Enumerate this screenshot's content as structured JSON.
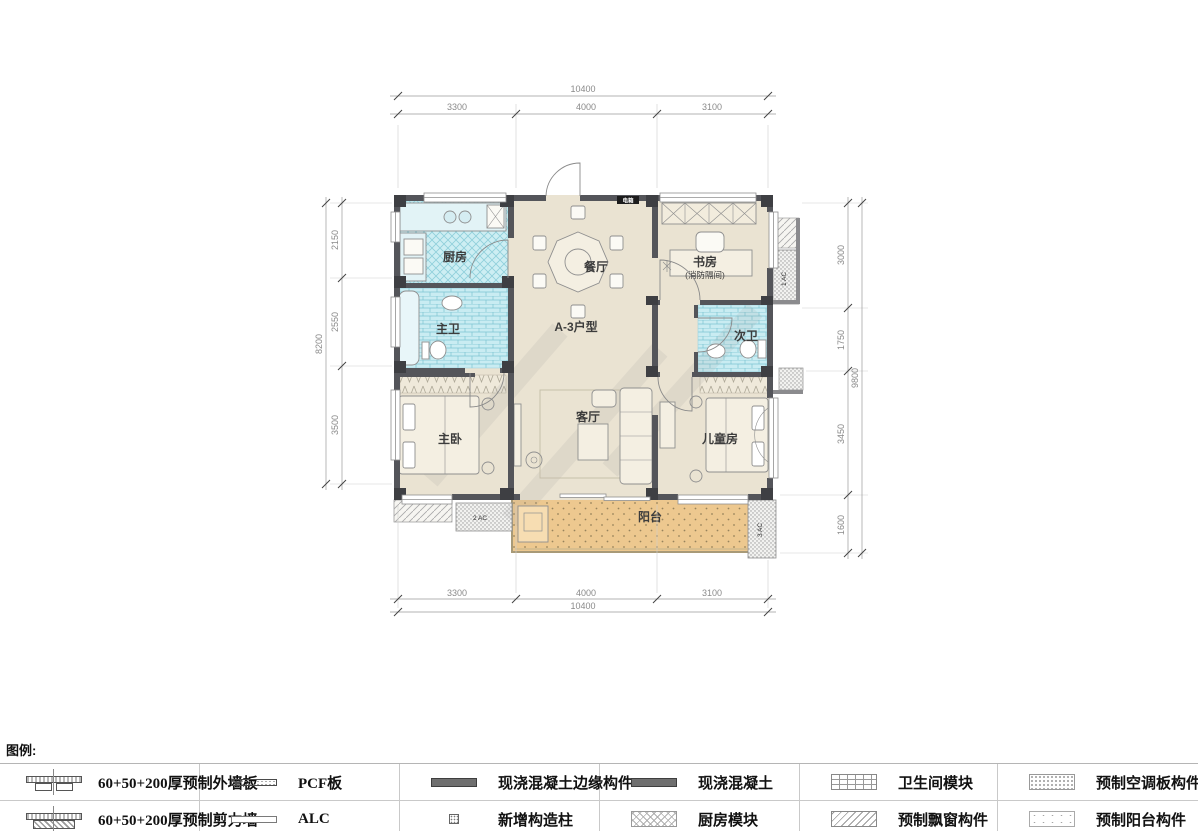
{
  "plan": {
    "unit_label": "A-3户型",
    "rooms": {
      "kitchen": "厨房",
      "dining": "餐厅",
      "study": "书房",
      "study_sub": "(消防隔间)",
      "master_bath": "主卫",
      "second_bath": "次卫",
      "master_bedroom": "主卧",
      "living": "客厅",
      "kids": "儿童房",
      "balcony": "阳台"
    },
    "small_labels": {
      "electrical_box": "电箱",
      "ac1": "1 AC",
      "ac2": "2 AC",
      "ac3": "3 AC"
    }
  },
  "dims": {
    "top": {
      "total": "10400",
      "segments": [
        "3300",
        "4000",
        "3100"
      ]
    },
    "bottom": {
      "total": "10400",
      "segments": [
        "3300",
        "4000",
        "3100"
      ]
    },
    "left": {
      "total": "8200",
      "segments": [
        "2150",
        "2550",
        "3500"
      ]
    },
    "right": {
      "total": "9800",
      "segments": [
        "3000",
        "1750",
        "3450",
        "1600"
      ]
    }
  },
  "legend": {
    "title": "图例:",
    "items": [
      {
        "label": "60+50+200厚预制外墙板",
        "symbol": "exterior-wall-panel"
      },
      {
        "label": "60+50+200厚预制剪力墙",
        "symbol": "shear-wall"
      },
      {
        "label": "PCF板",
        "symbol": "pcf-panel"
      },
      {
        "label": "ALC",
        "symbol": "alc-panel"
      },
      {
        "label": "现浇混凝土边缘构件",
        "symbol": "cast-in-place-edge-member"
      },
      {
        "label": "新增构造柱",
        "symbol": "new-structural-column"
      },
      {
        "label": "现浇混凝土",
        "symbol": "cast-in-place-concrete"
      },
      {
        "label": "厨房模块",
        "symbol": "kitchen-module"
      },
      {
        "label": "卫生间模块",
        "symbol": "bathroom-module"
      },
      {
        "label": "预制飘窗构件",
        "symbol": "precast-bay-window"
      },
      {
        "label": "预制空调板构件",
        "symbol": "precast-ac-panel"
      },
      {
        "label": "预制阳台构件",
        "symbol": "precast-balcony"
      }
    ]
  },
  "colors": {
    "wall": "#54555a",
    "floor": "#eae3d2",
    "wet_area": "#cdeef3",
    "balcony": "#edc88f"
  }
}
